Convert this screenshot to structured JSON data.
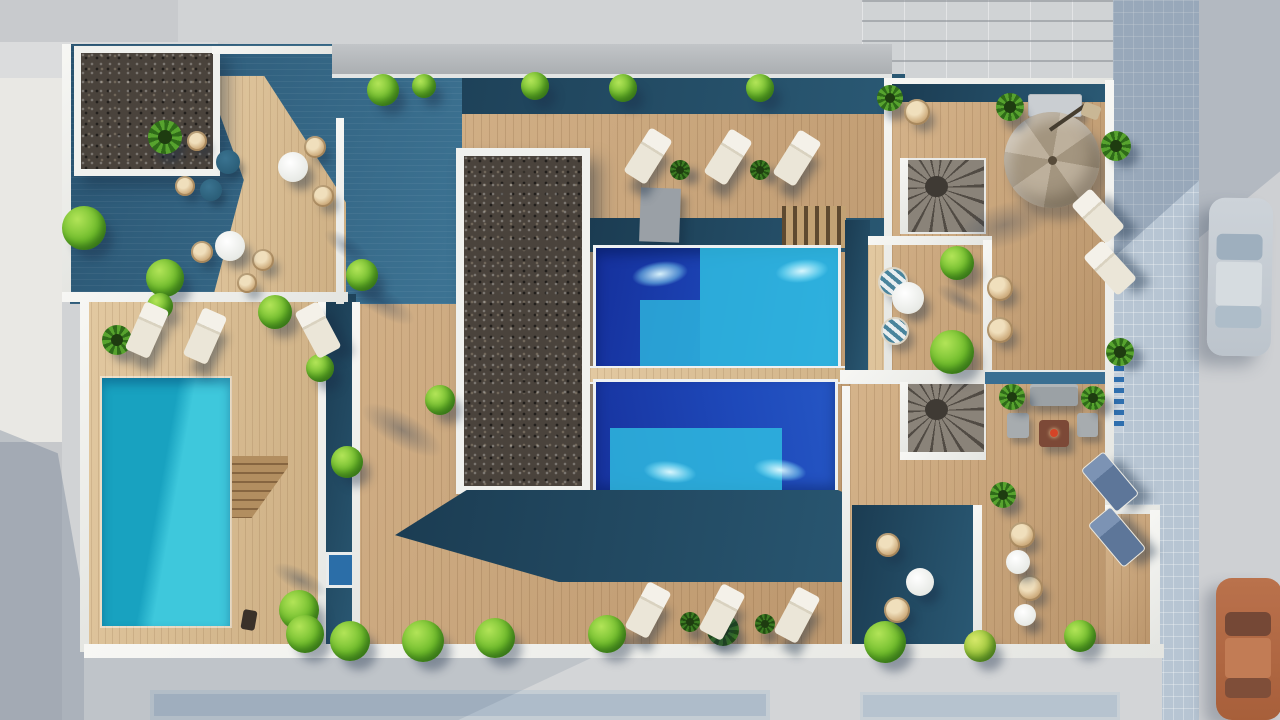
{
  "scene": {
    "type": "3d-architectural-render",
    "view": "top-down-aerial",
    "subject": "rooftop terrace with swimming pools, wooden decks, gravel beds, plants and street below"
  },
  "palette": {
    "street": "#cfd1d4",
    "sidewalk_tiles": "#b7c5d3",
    "building_roof": "#d0d3d5",
    "wall_white": "#f2f3f1",
    "deck_teal": "#2f5f7c",
    "deck_teal_dark": "#1f4458",
    "wood": "#c7a176",
    "wood_light": "#d6b88c",
    "gravel": "#4a433c",
    "pool_deep_blue": "#1c3ea8",
    "pool_turquoise": "#2fc2e2",
    "pool_left": "#21aecb",
    "bush_green": "#6dbb2a",
    "palm_green": "#2f6b19",
    "lounger_white": "#efeade",
    "lounger_blue": "#5d7699",
    "umbrella_tan": "#b3a692",
    "stair_gray": "#6e675e",
    "fire_table": "#7c4937",
    "fire_accent": "#d44427",
    "car_white": "#cbd2d8",
    "car_orange": "#c66c3d"
  },
  "objects": {
    "shadow_blobs": [
      [
        382,
        302,
        100,
        36,
        32
      ],
      [
        402,
        430,
        122,
        44,
        30
      ],
      [
        347,
        247,
        72,
        28,
        35
      ],
      [
        300,
        580,
        80,
        30,
        28
      ],
      [
        960,
        300,
        70,
        26,
        30
      ]
    ],
    "bushes": [
      [
        383,
        90,
        16
      ],
      [
        424,
        86,
        12
      ],
      [
        535,
        86,
        14
      ],
      [
        623,
        88,
        14
      ],
      [
        760,
        88,
        14
      ],
      [
        84,
        228,
        22
      ],
      [
        165,
        278,
        19
      ],
      [
        275,
        312,
        17
      ],
      [
        362,
        275,
        16
      ],
      [
        160,
        306,
        13
      ],
      [
        320,
        368,
        14
      ],
      [
        299,
        610,
        20
      ],
      [
        440,
        400,
        15
      ],
      [
        347,
        462,
        16
      ],
      [
        957,
        263,
        17
      ],
      [
        952,
        352,
        22
      ],
      [
        305,
        634,
        19
      ],
      [
        350,
        641,
        20
      ],
      [
        423,
        641,
        21
      ],
      [
        495,
        638,
        20
      ],
      [
        607,
        634,
        19
      ],
      [
        885,
        642,
        21
      ],
      [
        980,
        646,
        16,
        "yellow"
      ],
      [
        1080,
        636,
        16
      ]
    ],
    "palms": [
      [
        165,
        137,
        17
      ],
      [
        117,
        340,
        15
      ],
      [
        1010,
        107,
        14
      ],
      [
        890,
        98,
        13
      ],
      [
        1116,
        146,
        15
      ],
      [
        1120,
        352,
        14
      ],
      [
        1012,
        397,
        13
      ],
      [
        1093,
        398,
        12
      ],
      [
        1003,
        495,
        13
      ],
      [
        723,
        630,
        16,
        "dark"
      ],
      [
        680,
        170,
        10,
        "dark"
      ],
      [
        760,
        170,
        10,
        "dark"
      ],
      [
        690,
        622,
        10,
        "dark"
      ],
      [
        765,
        624,
        10,
        "dark"
      ]
    ],
    "white_loungers": [
      [
        635,
        130,
        32
      ],
      [
        715,
        131,
        32
      ],
      [
        784,
        132,
        32
      ],
      [
        134,
        304,
        24
      ],
      [
        192,
        310,
        24
      ],
      [
        305,
        304,
        -28
      ],
      [
        635,
        584,
        28
      ],
      [
        709,
        586,
        28
      ],
      [
        784,
        589,
        28
      ],
      [
        1085,
        190,
        -42
      ],
      [
        1097,
        242,
        -42
      ]
    ],
    "blue_loungers": [
      [
        1095,
        454,
        -40
      ],
      [
        1102,
        509,
        -40
      ]
    ],
    "wicker_chairs": [
      [
        197,
        141,
        10
      ],
      [
        185,
        186,
        10
      ],
      [
        315,
        147,
        11
      ],
      [
        323,
        196,
        11
      ],
      [
        202,
        252,
        11
      ],
      [
        263,
        260,
        11
      ],
      [
        247,
        283,
        10
      ],
      [
        917,
        112,
        13
      ],
      [
        1000,
        288,
        13
      ],
      [
        1000,
        330,
        13
      ],
      [
        1022,
        535,
        13
      ],
      [
        1030,
        588,
        13
      ],
      [
        888,
        545,
        12
      ],
      [
        897,
        610,
        13
      ]
    ],
    "striped_chairs": [
      [
        893,
        282,
        15
      ],
      [
        895,
        331,
        14
      ]
    ],
    "white_tables": [
      [
        293,
        167,
        15
      ],
      [
        230,
        246,
        15
      ],
      [
        908,
        298,
        16
      ],
      [
        1018,
        562,
        12
      ],
      [
        1025,
        615,
        11
      ],
      [
        920,
        582,
        14
      ]
    ],
    "teal_tables": [
      [
        228,
        162,
        12
      ],
      [
        211,
        190,
        11
      ]
    ]
  }
}
